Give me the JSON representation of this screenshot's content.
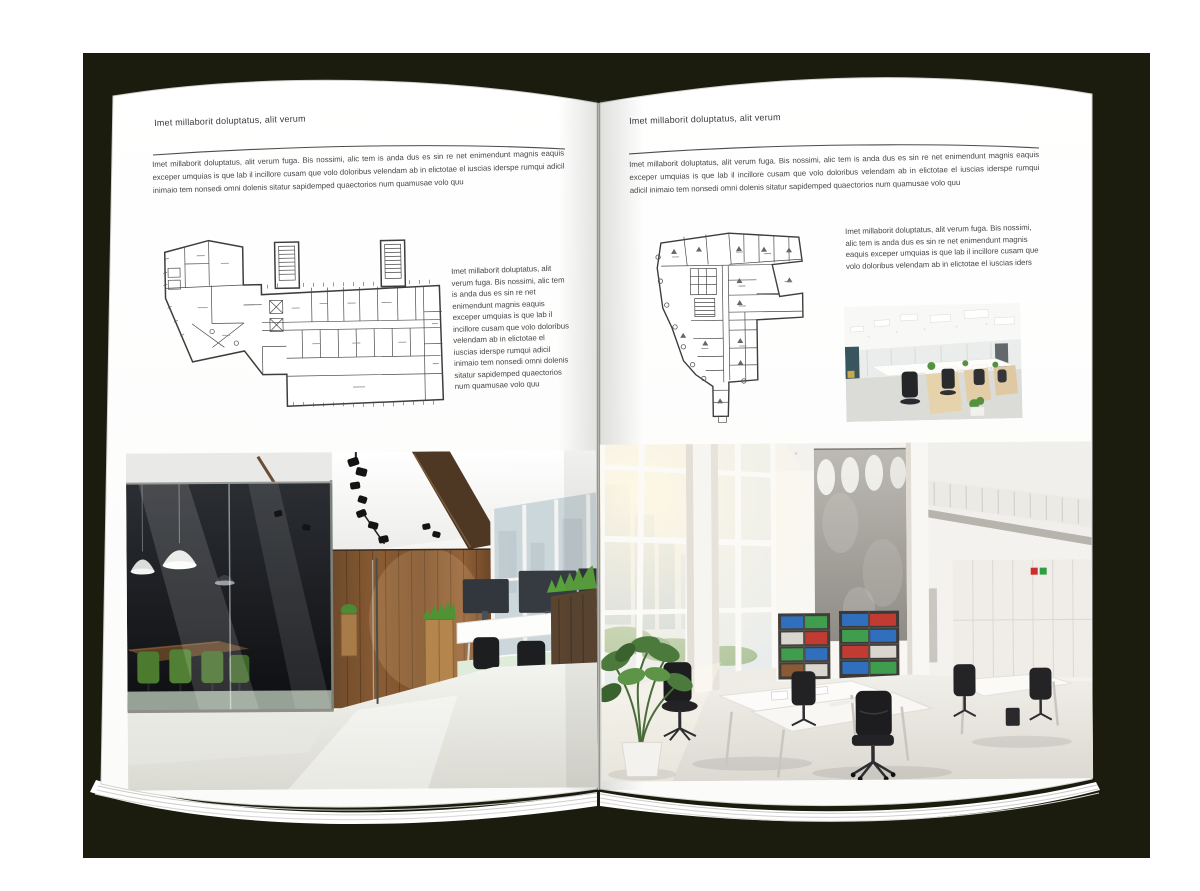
{
  "backdrop": {
    "color": "#1b1c0e"
  },
  "left_page": {
    "header": "Imet millaborit doluptatus, alit verum",
    "intro": "Imet millaborit doluptatus, alit verum fuga. Bis nossimi, alic tem is anda dus es sin re net enimendunt magnis eaquis exceper umquias is que lab il incillore cusam que volo doloribus velendam ab in elictotae el iuscias iderspe rumqui adicil inimaio tem nonsedi omni dolenis sitatur sapidemped quaectorios num quamusae volo quu",
    "side_text": "Imet millaborit doluptatus, alit verum fuga. Bis nossimi, alic tem is anda dus es sin re net enimendunt magnis eaquis exceper umquias is que lab il incillore cusam que volo doloribus velendam ab in elictotae el iuscias iderspe rumqui adicil inimaio tem nonsedi omni dolenis sitatur sapidemped quaectorios num quamusae volo quu"
  },
  "right_page": {
    "header": "Imet millaborit doluptatus, alit verum",
    "intro": "Imet millaborit doluptatus, alit verum fuga. Bis nossimi, alic tem is anda dus es sin re net enimendunt magnis eaquis exceper umquias is que lab il incillore cusam que volo doloribus velendam ab in elictotae el iuscias iderspe rumqui adicil inimaio tem nonsedi omni dolenis sitatur sapidemped quaectorios num quamusae volo quu",
    "side_text": "Imet millaborit doluptatus, alit verum fuga. Bis nossimi, alic tem is anda dus es sin re net enimendunt magnis eaquis exceper umquias is que lab il incillore cusam que volo doloribus velendam ab in elictotae el iuscias iders"
  },
  "accents": {
    "wood_wall": "#7a5130",
    "plant_green": "#55923f",
    "binder_blue": "#2f6fbd",
    "binder_green": "#3f9e4d",
    "binder_red": "#c23b33"
  }
}
